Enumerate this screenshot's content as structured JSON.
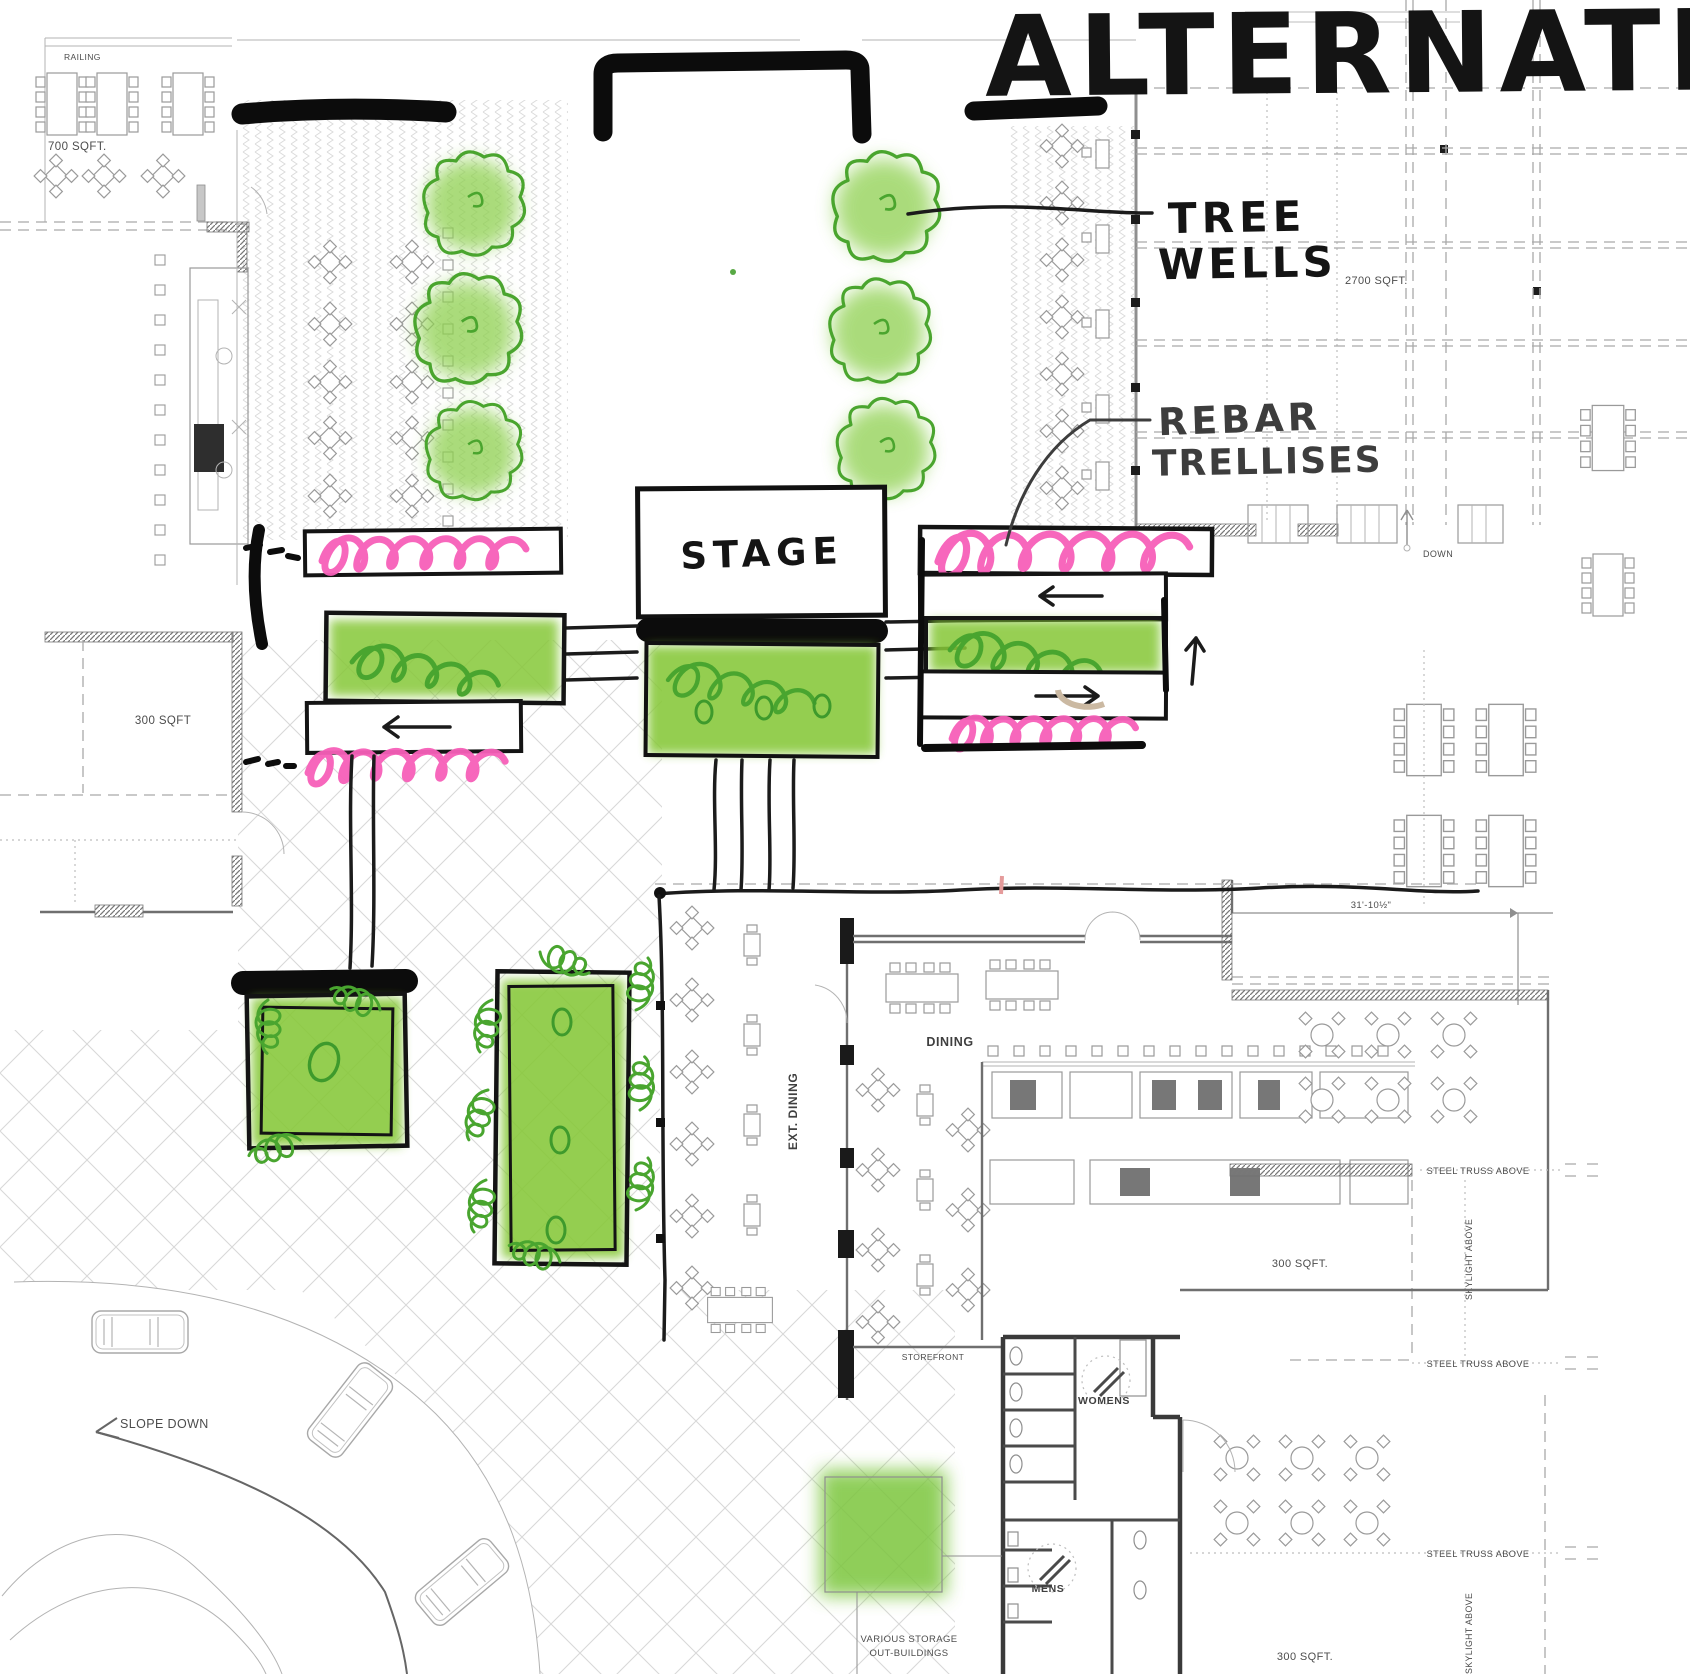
{
  "colors": {
    "marker_black": "#0c0c0c",
    "highlight_green": "#7dc63e",
    "scribble_green": "#49a52f",
    "annotation_pink": "#f75fb8",
    "alternate_red": "#e59191",
    "plan_gray": "#9a9a9a"
  },
  "handwritten": {
    "alternate": "ALTERNATE",
    "tree_wells_1": "TREE",
    "tree_wells_2": "WELLS",
    "rebar_1": "REBAR",
    "rebar_2": "TRELLISES",
    "stage": "STAGE"
  },
  "plan": {
    "railing": "RAILING",
    "sqft_700": "700 SQFT.",
    "sqft_2700": "2700 SQFT.",
    "down": "DOWN",
    "sqft_300_left": "300 SQFT",
    "dim_31": "31'-10½\"",
    "dining": "DINING",
    "ext_dining": "EXT. DINING",
    "storefront": "STOREFRONT",
    "steel_truss": "STEEL TRUSS ABOVE",
    "skylight": "SKYLIGHT ABOVE",
    "sqft_300_mid": "300 SQFT.",
    "sqft_300_bottom": "300 SQFT.",
    "womens": "WOMENS",
    "mens": "MENS",
    "slope_down": "SLOPE DOWN",
    "storage_1": "VARIOUS STORAGE",
    "storage_2": "OUT-BUILDINGS"
  }
}
